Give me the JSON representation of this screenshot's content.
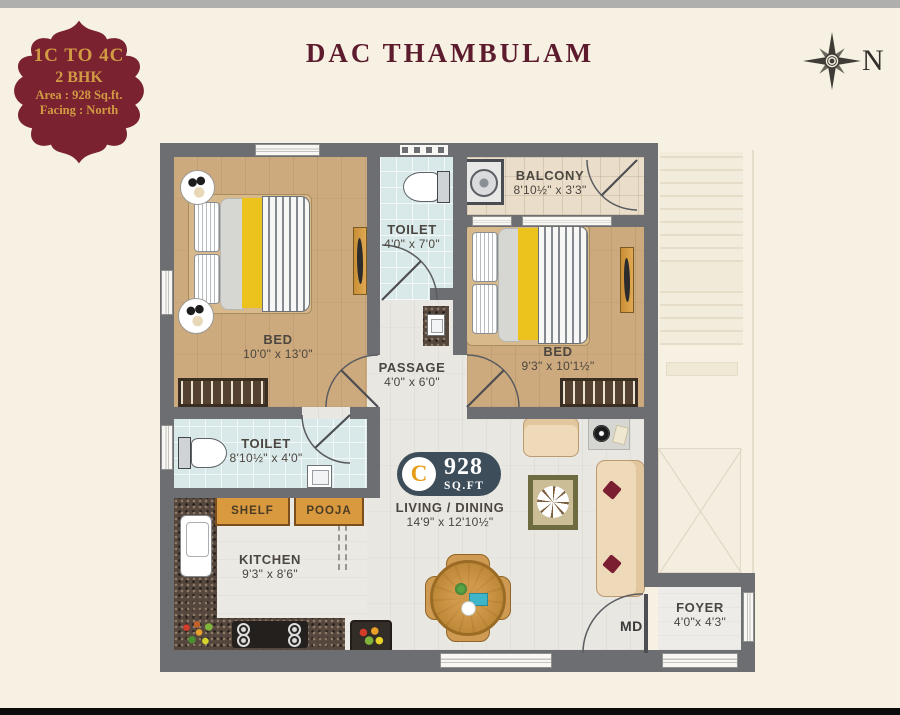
{
  "header": {
    "badge": {
      "line1": "1C TO 4C",
      "line2": "2 BHK",
      "line3": "Area : 928 Sq.ft.",
      "line4": "Facing : North"
    },
    "title": "DAC THAMBULAM",
    "compass_label": "N"
  },
  "plan": {
    "area_badge": {
      "letter": "C",
      "value": "928",
      "unit": "SQ.FT"
    },
    "rooms": {
      "bed1": {
        "name": "BED",
        "dims": "10'0\" x 13'0\""
      },
      "toilet1": {
        "name": "TOILET",
        "dims": "4'0\" x 7'0\""
      },
      "balcony": {
        "name": "BALCONY",
        "dims": "8'10½\" x 3'3\""
      },
      "bed2": {
        "name": "BED",
        "dims": "9'3\" x 10'1½\""
      },
      "passage": {
        "name": "PASSAGE",
        "dims": "4'0\" x 6'0\""
      },
      "toilet2": {
        "name": "TOILET",
        "dims": "8'10½\" x 4'0\""
      },
      "shelf": {
        "name": "SHELF"
      },
      "pooja": {
        "name": "POOJA"
      },
      "kitchen": {
        "name": "KITCHEN",
        "dims": "9'3\" x 8'6\""
      },
      "living": {
        "name": "LIVING / DINING",
        "dims": "14'9\" x 12'10½\""
      },
      "foyer": {
        "name": "FOYER",
        "dims": "4'0\"x 4'3\""
      },
      "main_door": {
        "label": "MD"
      }
    },
    "colors": {
      "accent_maroon": "#7a2230",
      "gold": "#d29b43",
      "badge_navy": "#3d4d59",
      "wall_gray": "#6c6e72",
      "wood_floor": "#cdaa7e",
      "tile_blue": "#d9e9e9",
      "label_text": "#4b463f"
    }
  }
}
